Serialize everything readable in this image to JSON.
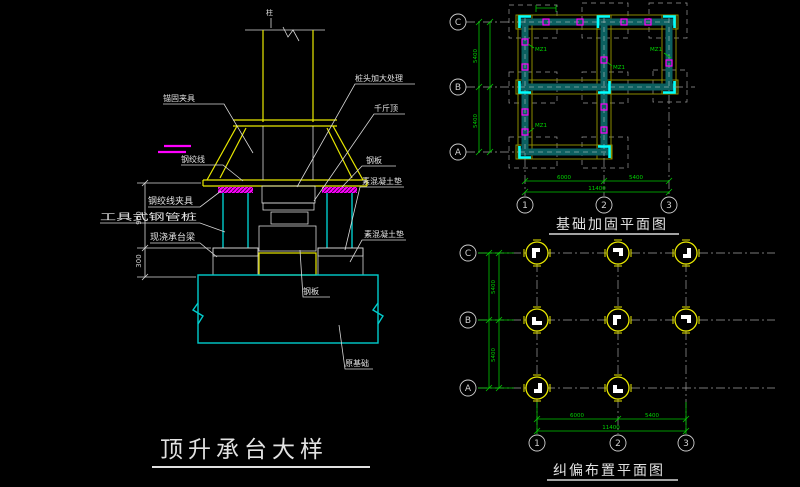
{
  "detail": {
    "title": "顶升承台大样",
    "labels": {
      "column": "柱",
      "clamp": "锚固夹具",
      "strand": "钢绞线",
      "pile_head": "桩头加大处理",
      "jack": "千斤顶",
      "steel_plate_right": "钢板",
      "pad_upper": "素混凝土垫",
      "pad_lower": "素混凝土垫",
      "steel_plate_bottom": "钢板",
      "original_foundation": "原基础",
      "strand_clamp": "钢绞线夹具",
      "tool_pipe_pile": "工具式钢管桩",
      "cast_beam": "现浇承台梁"
    },
    "dims": {
      "v1": "900",
      "v2": "300"
    }
  },
  "plan_top": {
    "title": "基础加固平面图",
    "rows": [
      "C",
      "B",
      "A"
    ],
    "cols": [
      "1",
      "2",
      "3"
    ],
    "dims": {
      "left_1": "5400",
      "left_2": "5400",
      "bottom_1": "6000",
      "bottom_2": "5400",
      "bottom_total": "11400"
    },
    "pile_mark": "MZ1"
  },
  "plan_bottom": {
    "title": "纠偏布置平面图",
    "rows": [
      "C",
      "B",
      "A"
    ],
    "cols": [
      "1",
      "2",
      "3"
    ],
    "dims": {
      "left_1": "5400",
      "left_2": "5400",
      "bottom_1": "6000",
      "bottom_2": "5400",
      "bottom_total": "11400"
    }
  }
}
